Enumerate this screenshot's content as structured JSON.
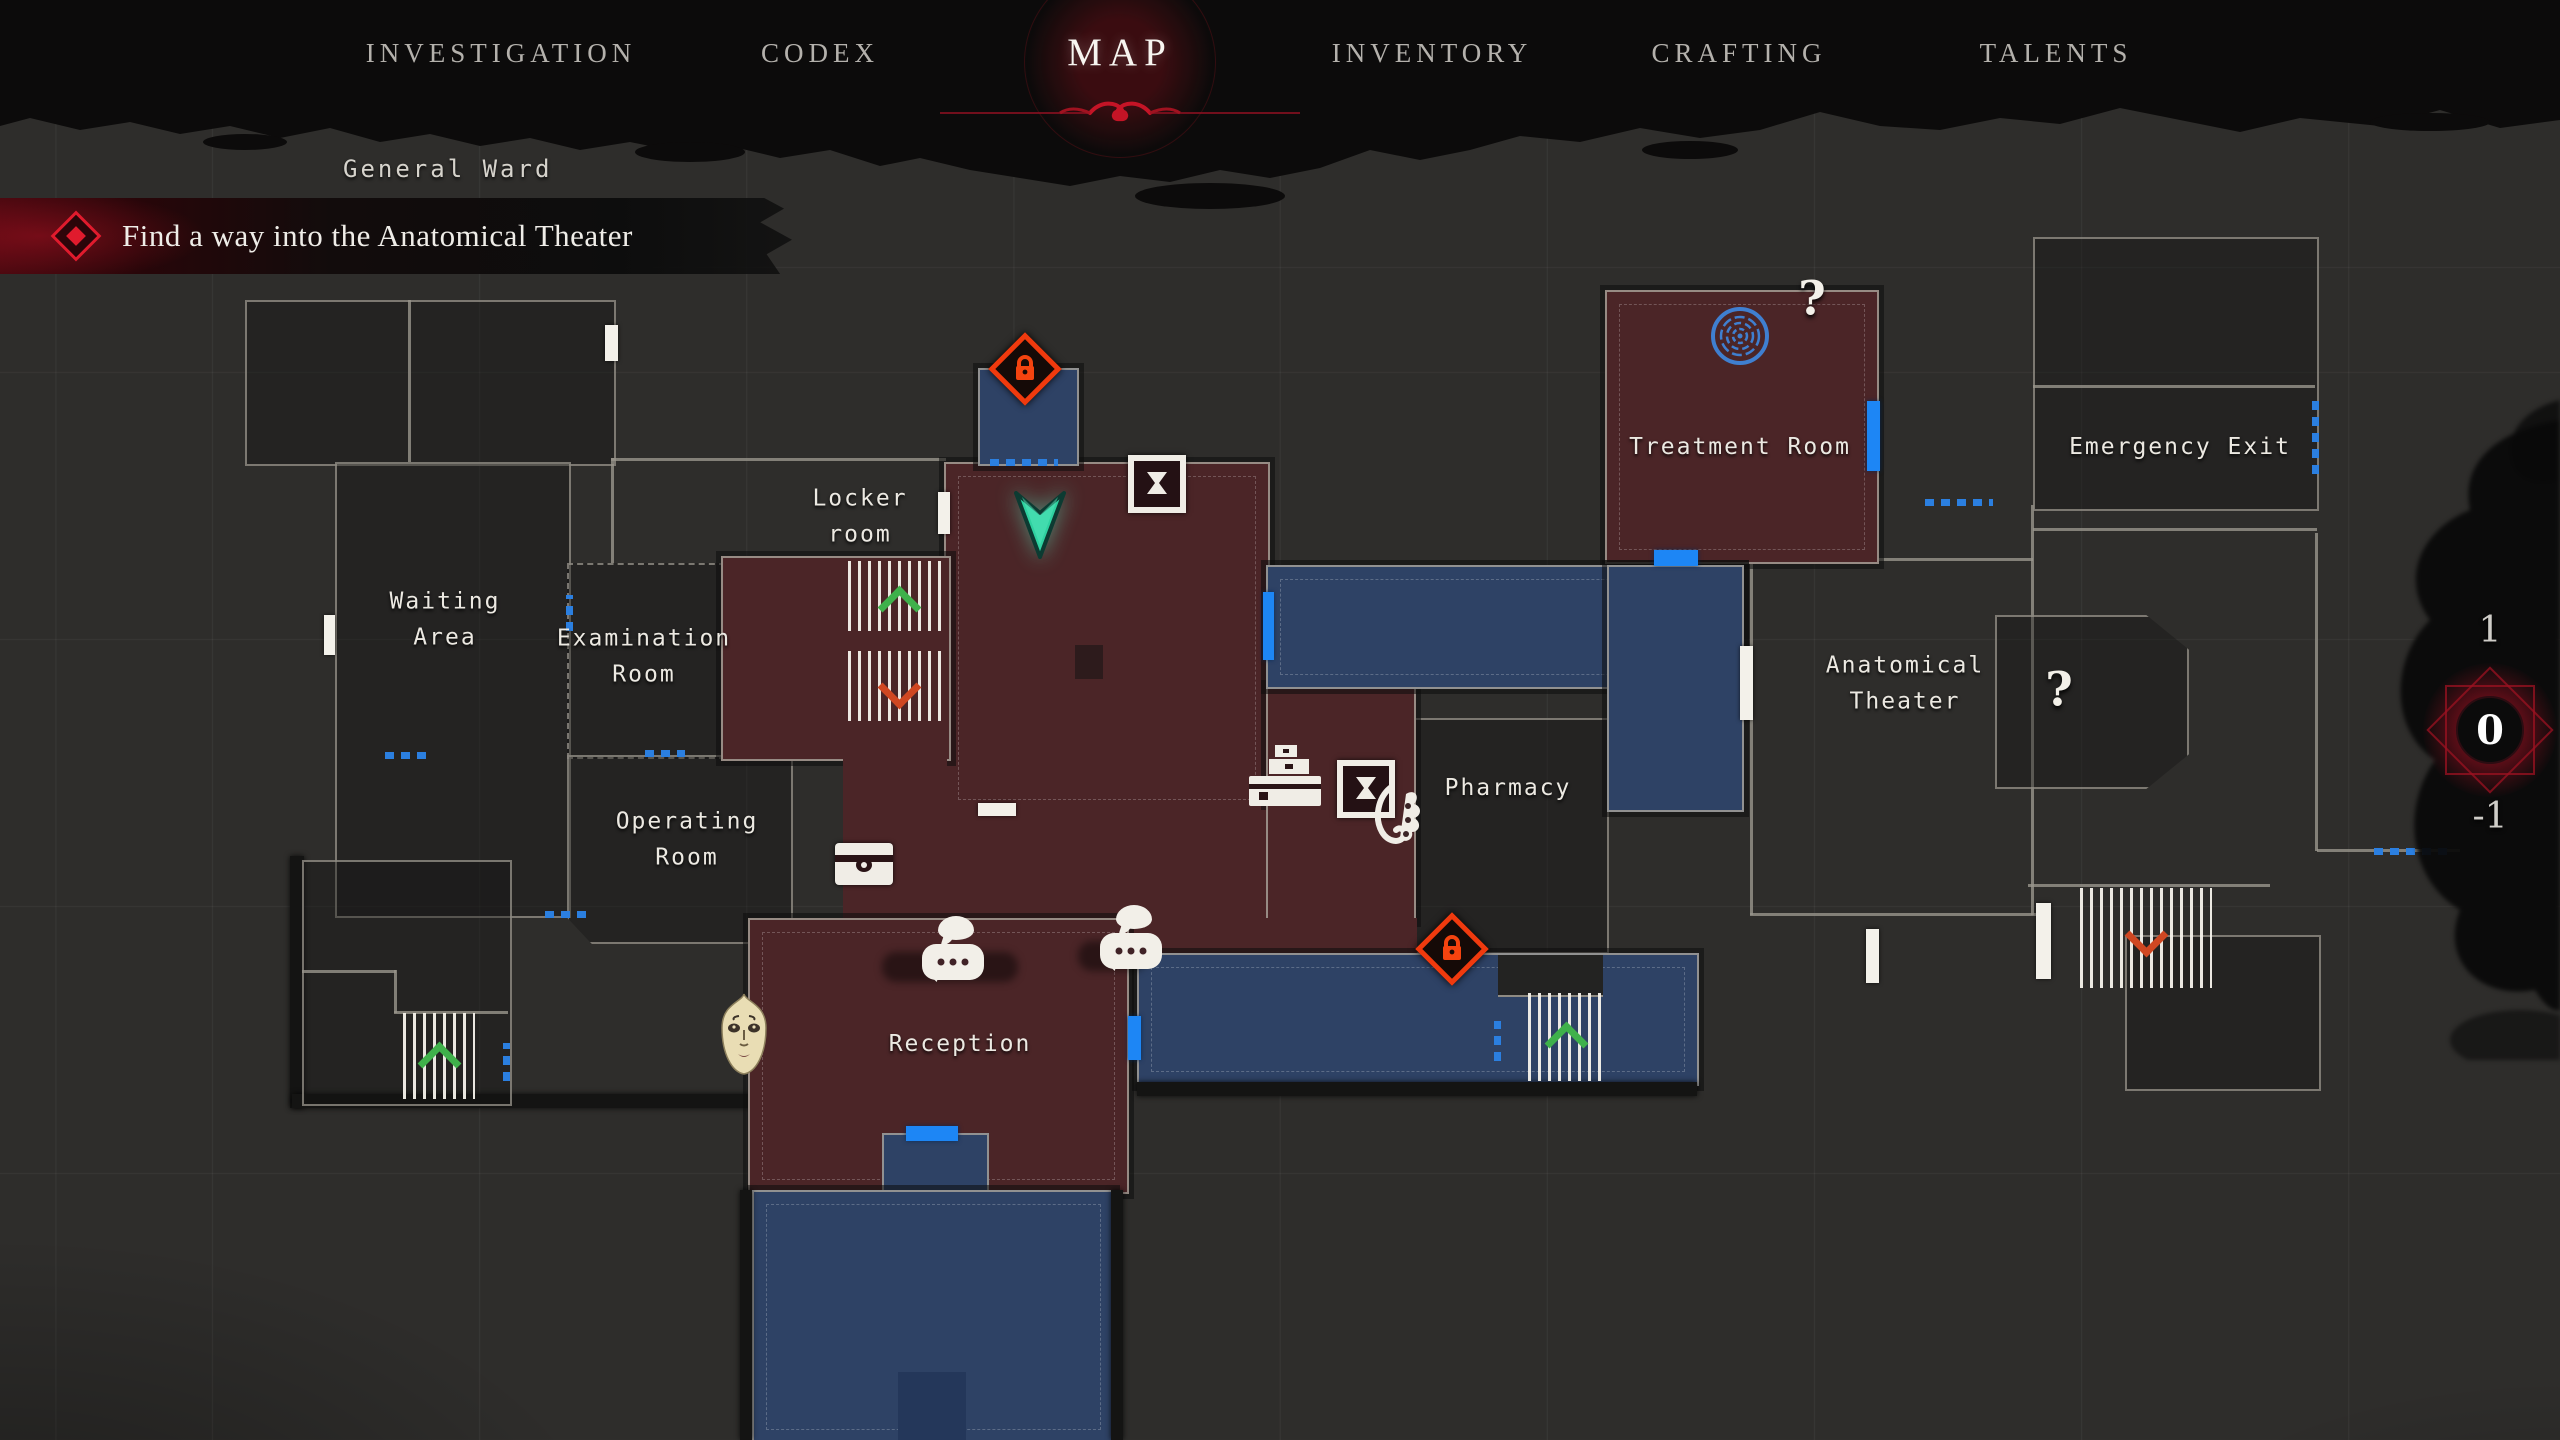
{
  "nav": {
    "tabs": [
      {
        "label": "INVESTIGATION",
        "active": false
      },
      {
        "label": "CODEX",
        "active": false
      },
      {
        "label": "MAP",
        "active": true
      },
      {
        "label": "INVENTORY",
        "active": false
      },
      {
        "label": "CRAFTING",
        "active": false
      },
      {
        "label": "TALENTS",
        "active": false
      }
    ]
  },
  "header": {
    "area_label": "General Ward"
  },
  "objective": {
    "text": "Find a way into the Anatomical Theater"
  },
  "floor_selector": {
    "above": "1",
    "current": "0",
    "below": "-1"
  },
  "rooms": {
    "waiting_area": {
      "label": "Waiting Area"
    },
    "examination_room": {
      "label": "Examination Room"
    },
    "operating_room": {
      "label": "Operating Room"
    },
    "locker_room": {
      "label": "Locker room"
    },
    "reception": {
      "label": "Reception"
    },
    "pharmacy": {
      "label": "Pharmacy"
    },
    "treatment_room": {
      "label": "Treatment Room"
    },
    "emergency_exit": {
      "label": "Emergency Exit"
    },
    "anatomical_theater": {
      "label": "Anatomical Theater"
    }
  },
  "markers": {
    "question_mark": "?"
  },
  "icons": {
    "player": "player-arrow",
    "locked_door": "lock-diamond",
    "save_point": "hourglass-box",
    "storage_chest": "chest",
    "workbench": "desk",
    "hanging_item": "hook",
    "conversation": "speech-bubbles",
    "npc_face": "face-mask",
    "point_of_interest": "blue-spiral",
    "stairs_up": "green-chevron",
    "stairs_down": "red-chevron"
  },
  "colors": {
    "explored_room": "#4b2527",
    "objective_path_room": "#2e4265",
    "door_highlight": "#1d86f5",
    "locked_accent": "#f03a0e",
    "player_accent": "#2fd1a0",
    "objective_accent": "#e01b2d",
    "background": "#2e2d2b"
  }
}
